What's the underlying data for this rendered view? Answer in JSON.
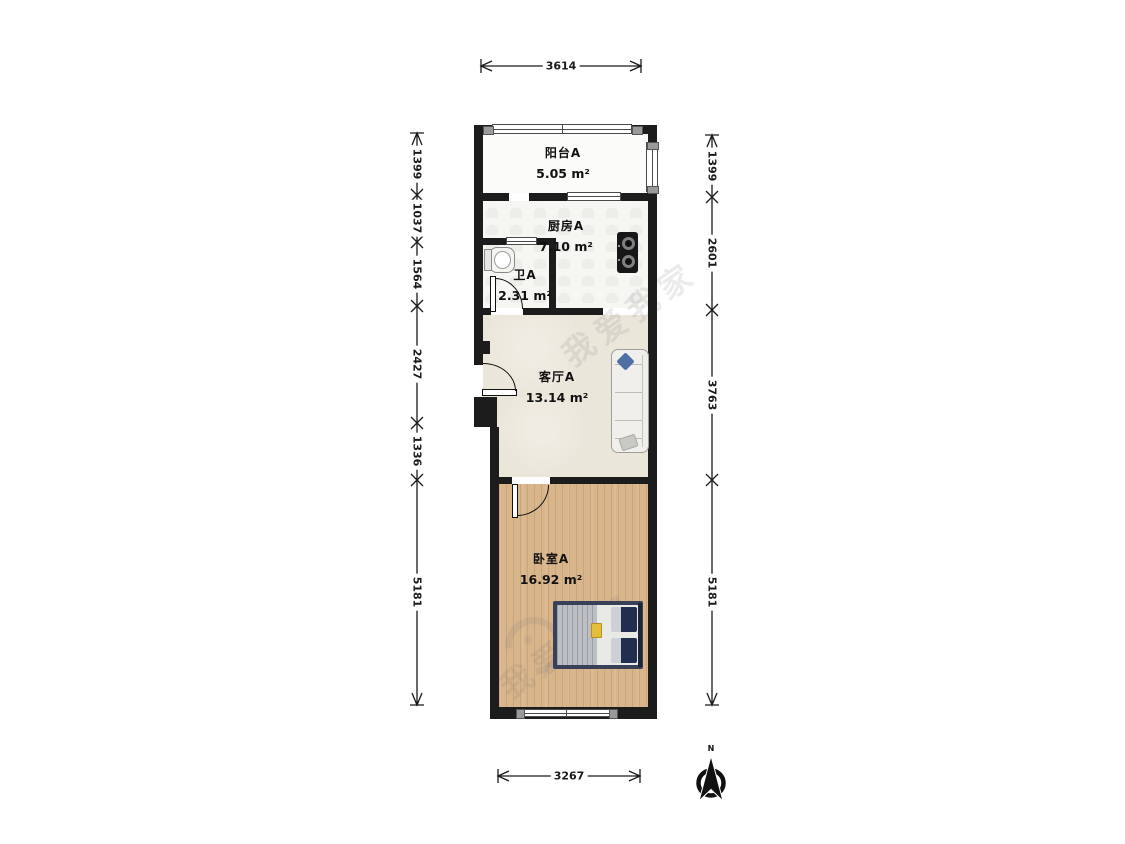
{
  "floorplan": {
    "rooms": {
      "balcony": {
        "name": "阳台A",
        "area": "5.05 m²"
      },
      "kitchen": {
        "name": "厨房A",
        "area": "7.10 m²"
      },
      "bathroom": {
        "name": "卫A",
        "area": "2.31 m²"
      },
      "living": {
        "name": "客厅A",
        "area": "13.14 m²"
      },
      "bedroom": {
        "name": "卧室A",
        "area": "16.92 m²"
      }
    },
    "dimensions_mm": {
      "top_total": "3614",
      "bottom_total": "3267",
      "left_segments": [
        "1399",
        "1037",
        "1564",
        "2427",
        "1336",
        "5181"
      ],
      "right_segments": [
        "1399",
        "2601",
        "3763",
        "5181"
      ]
    },
    "compass": {
      "north_label": "N"
    },
    "watermark": {
      "brand": "我爱我家"
    },
    "colors": {
      "wall": "#1c1c1c",
      "tile_floor": "#f6f6f3",
      "living_floor": "#ebe6da",
      "wood_floor": "#d9b58c",
      "sofa_pillow_blue": "#4d6fa3",
      "bed_pillow_navy": "#222e4f",
      "bed_accent_yellow": "#e4bd3a"
    }
  }
}
